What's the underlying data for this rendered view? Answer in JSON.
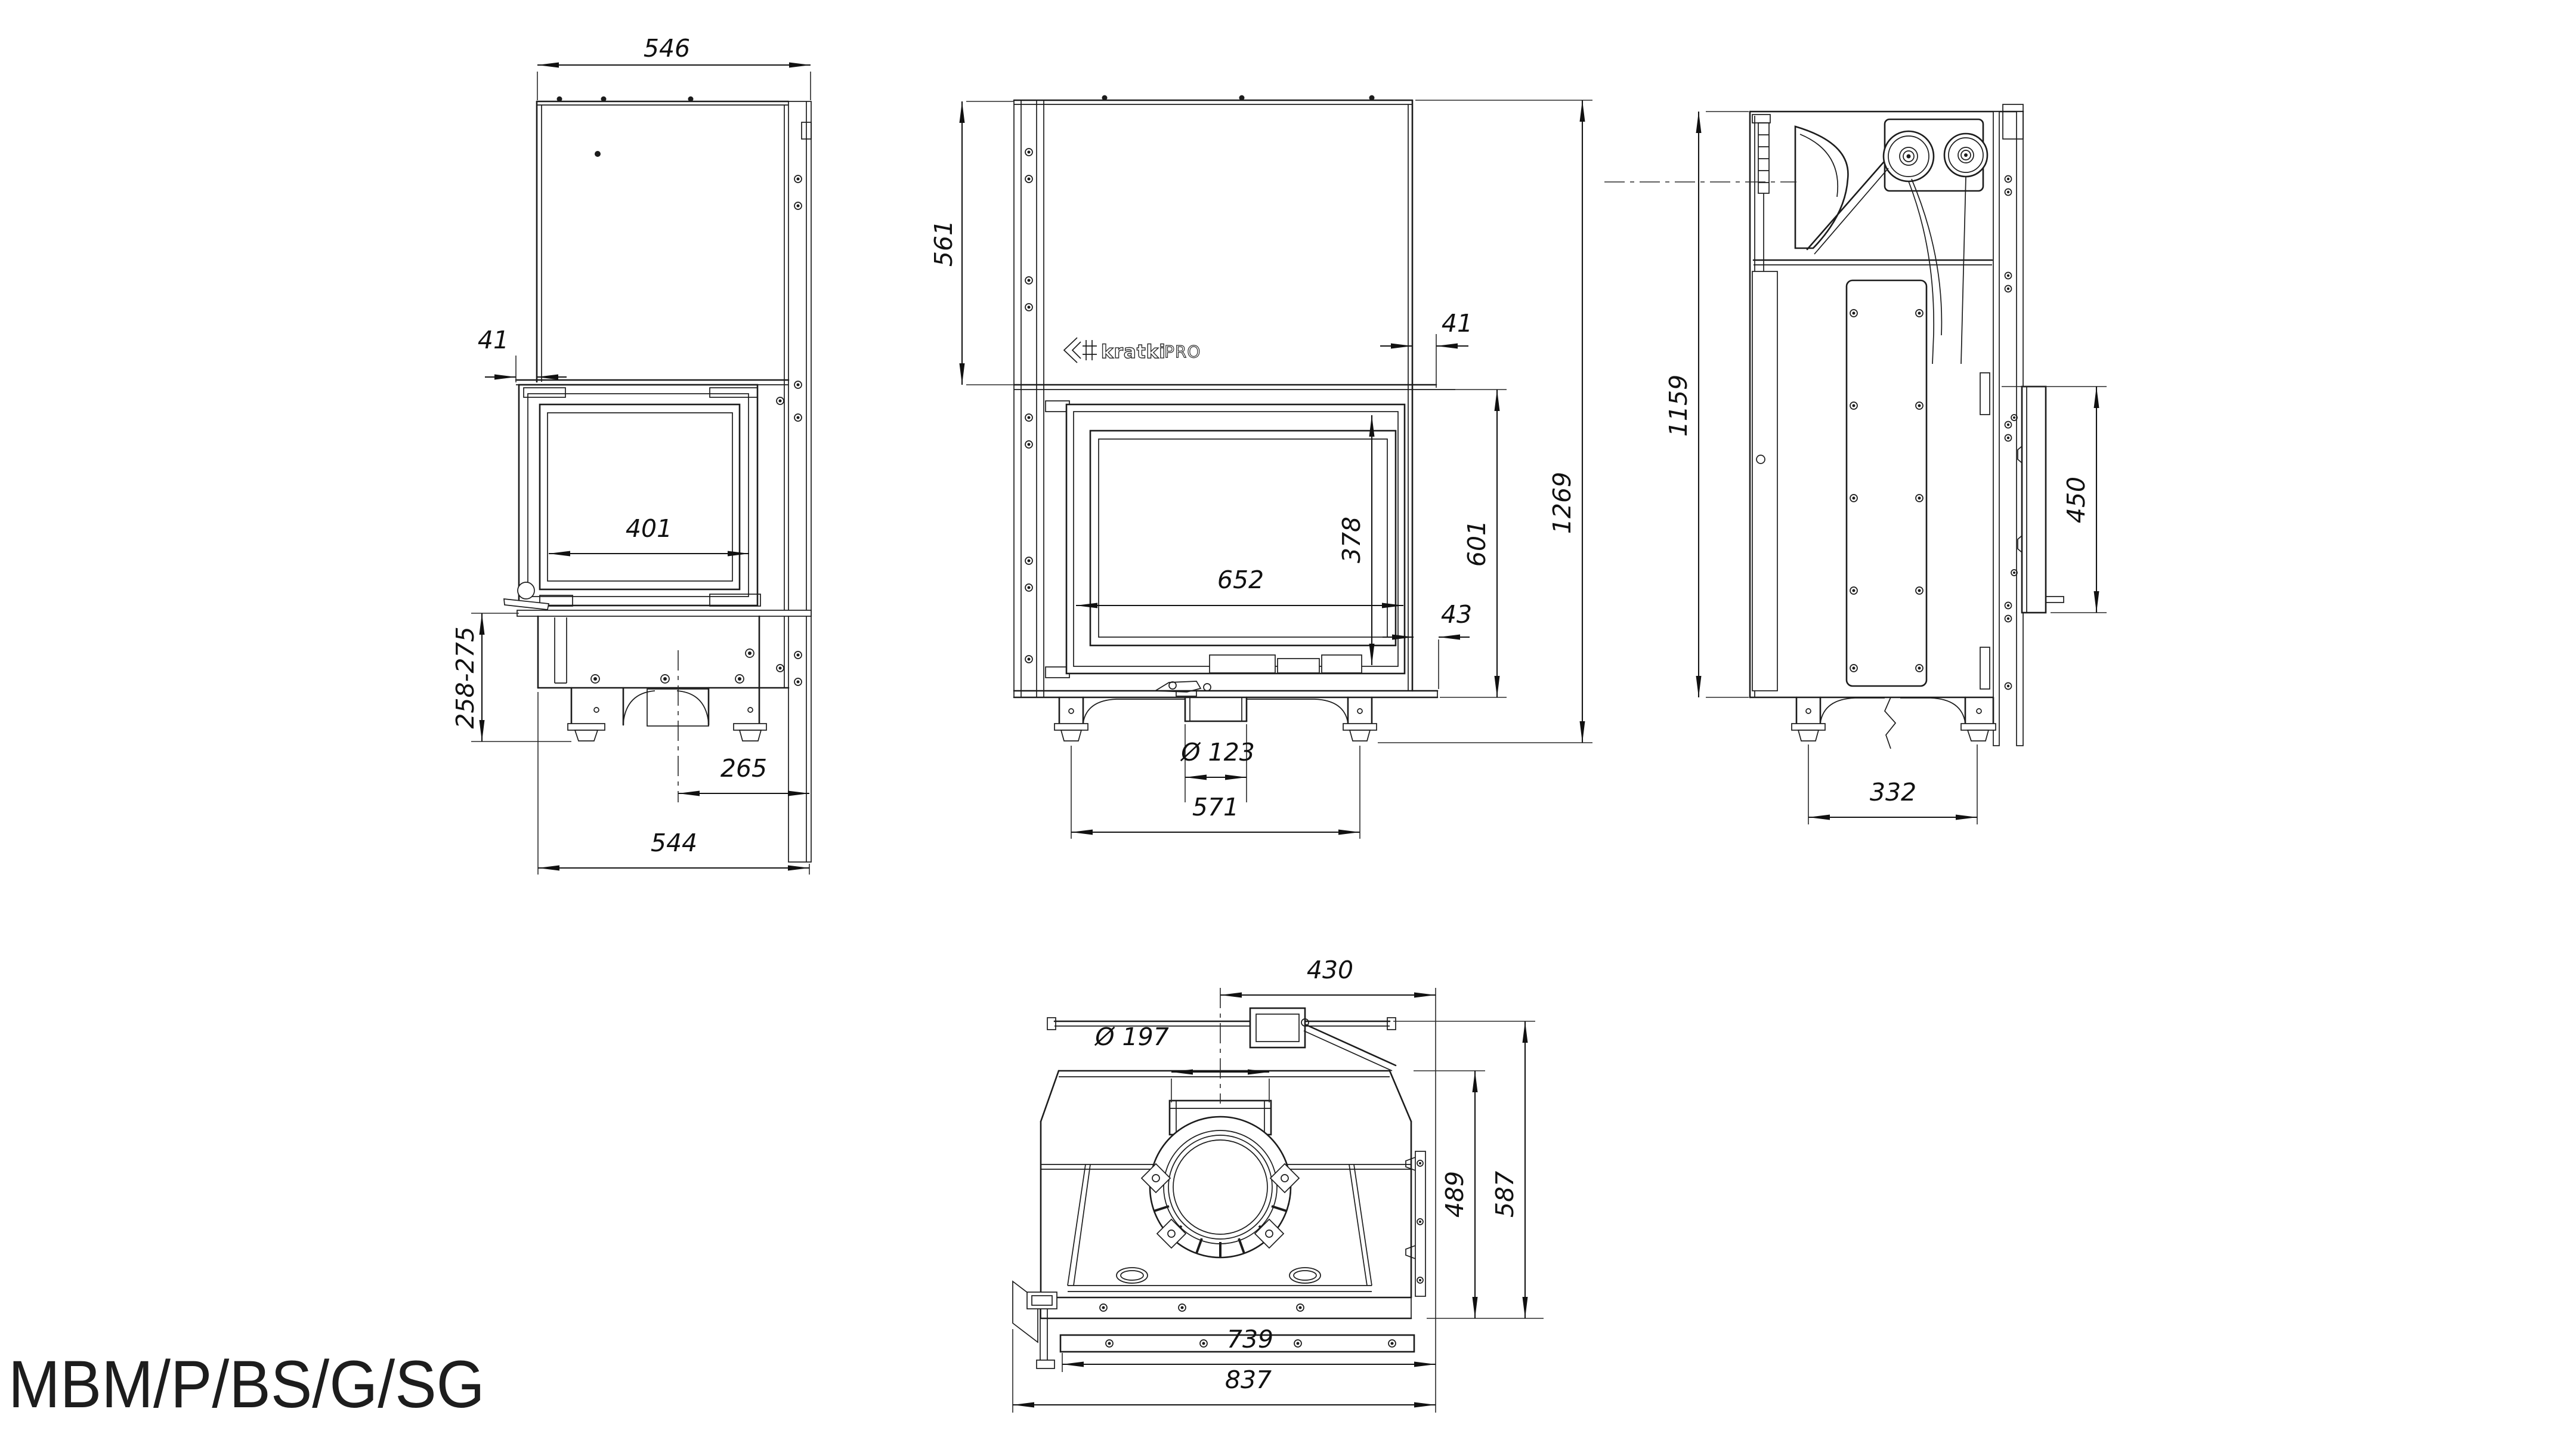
{
  "title": "MBM/P/BS/G/SG",
  "logo": {
    "brand": "kratki",
    "suffix": "PRO"
  },
  "drawing": {
    "line_color": "#1c1c1c",
    "background": "#ffffff",
    "dim_text_style": "italic"
  },
  "views": {
    "side_left": {
      "name": "left side view",
      "dims": {
        "top_width": "546",
        "door_offset": "41",
        "side_glass_width": "401",
        "base_height_range": "258-275",
        "back_offset": "265",
        "total_depth": "544"
      }
    },
    "front": {
      "name": "front view",
      "dims": {
        "upper_chamber_height": "561",
        "back_offset": "41",
        "glass_width": "652",
        "glass_height": "378",
        "firebox_height": "601",
        "total_height": "1269",
        "bottom_offset": "43",
        "flue_pipe_diameter": "Ø 123",
        "leg_spacing": "571"
      }
    },
    "side_right": {
      "name": "right side section view",
      "dims": {
        "overall_height": "1159",
        "mount_bracket_height": "450",
        "leg_spacing": "332"
      }
    },
    "top": {
      "name": "top view",
      "dims": {
        "flue_center_offset": "430",
        "collar_diameter": "Ø 197",
        "body_depth": "489",
        "total_depth": "587",
        "body_width": "739",
        "total_width": "837"
      }
    }
  }
}
